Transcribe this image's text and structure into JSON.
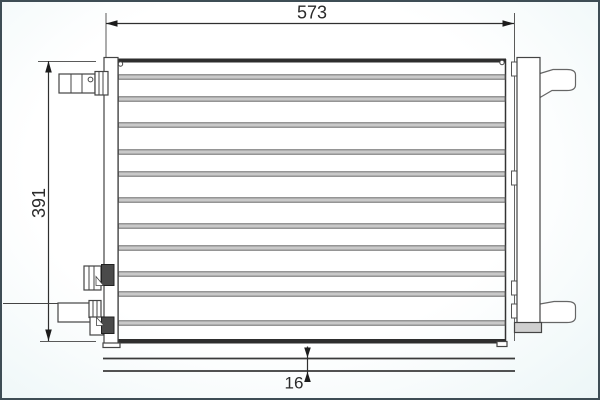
{
  "drawing": {
    "type": "technical-dimension-drawing",
    "subject": "condenser-front-view-with-thickness-profile",
    "dim_width": {
      "label": "573"
    },
    "dim_height": {
      "label": "391"
    },
    "dim_depth": {
      "label": "16"
    },
    "core": {
      "tube_rows_y": [
        77,
        99,
        125,
        152,
        174,
        200,
        226,
        248,
        274,
        294,
        323
      ]
    },
    "side_plate_clips_y": [
      62,
      171,
      281,
      304
    ],
    "colors": {
      "band_fill": "#c9c9c9",
      "band_edge": "#5c5c5c",
      "edge_dark": "#2e2e2e",
      "block_fill": "#4a4a4a",
      "frame": "#3E4D55"
    }
  }
}
